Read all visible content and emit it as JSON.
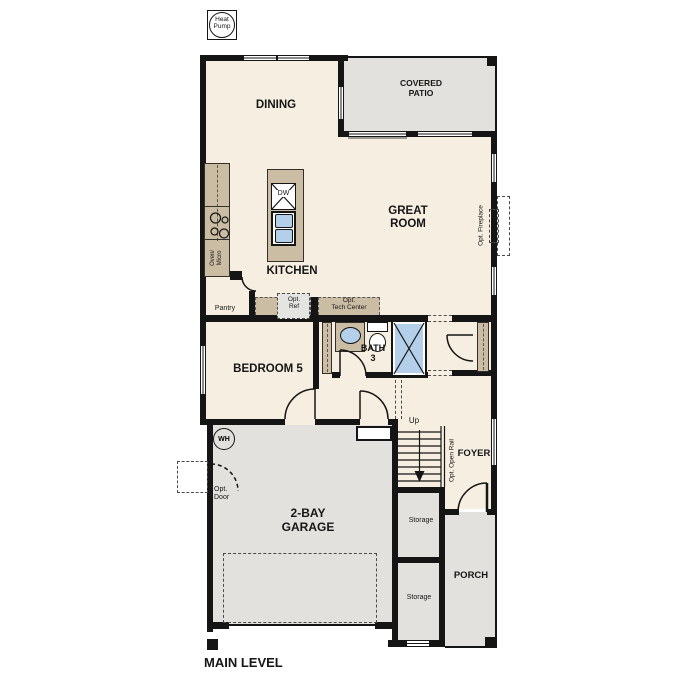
{
  "title": "MAIN LEVEL",
  "colors": {
    "floor_cream": "#f6efe1",
    "cabinet_tan": "#cbbda3",
    "exterior_gray": "#e2e1dd",
    "fixture_blue": "#b3cfe9",
    "wall_black": "#151515"
  },
  "rooms": {
    "dining": "DINING",
    "covered_patio": "COVERED\nPATIO",
    "great_room": "GREAT\nROOM",
    "kitchen": "KITCHEN",
    "pantry": "Pantry",
    "bedroom5": "BEDROOM 5",
    "bath3": "BATH\n3",
    "foyer": "FOYER",
    "garage": "2-BAY\nGARAGE",
    "porch": "PORCH",
    "storage": "Storage"
  },
  "options": {
    "fireplace": "Opt. Fireplace",
    "ref": "Opt.\nRef",
    "tech_center": "Opt.\nTech Center",
    "open_rail": "Opt. Open Rail",
    "door": "Opt.\nDoor"
  },
  "equipment": {
    "heat_pump": "Heat\nPump",
    "water_heater": "WH",
    "dishwasher": "DW",
    "oven_micro": "Oven/\nMicro"
  },
  "stairs": {
    "up": "Up"
  }
}
